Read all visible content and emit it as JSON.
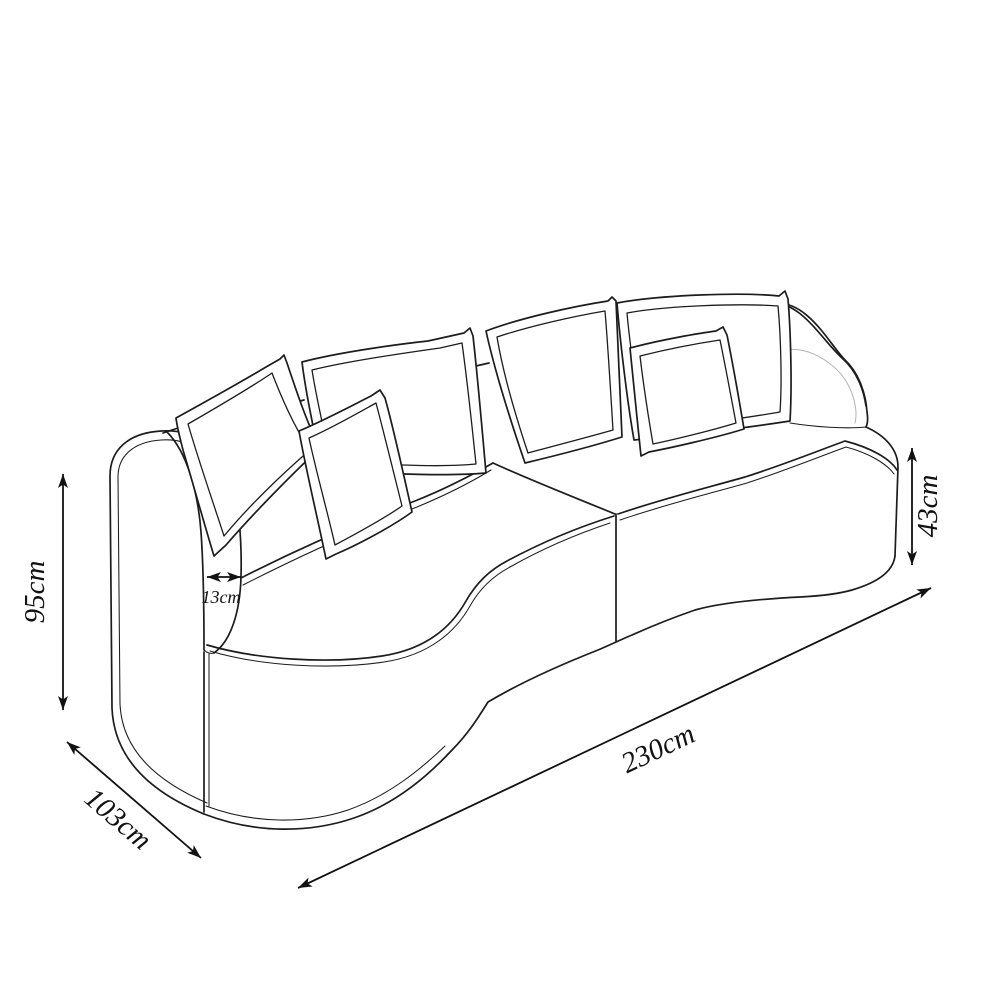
{
  "canvas": {
    "background": "#ffffff",
    "line_color": "#1c1c1c"
  },
  "drawing": {
    "subject": "curved sofa technical line drawing",
    "back_pillow_count": 4,
    "front_pillow_count": 2
  },
  "dimensions": {
    "height": "95cm",
    "depth": "103cm",
    "width": "230cm",
    "seat_height": "43cm",
    "armrest_thickness": "13cm"
  }
}
